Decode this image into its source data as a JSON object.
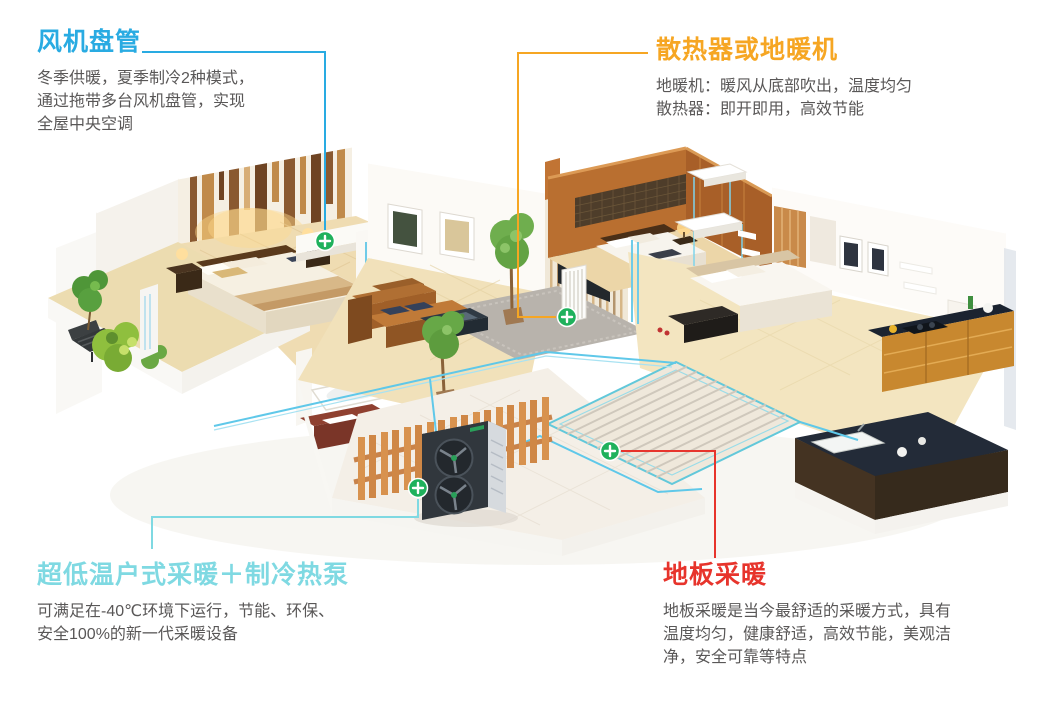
{
  "page": {
    "background": "#ffffff",
    "width": 1042,
    "height": 710
  },
  "colors": {
    "cyan_accent": "#29abe2",
    "light_cyan_accent": "#7fd9e2",
    "orange_accent": "#f6a623",
    "red_accent": "#e7342c",
    "body_text": "#595757",
    "marker_green": "#1fb15c"
  },
  "annotations": {
    "fan_coil": {
      "title": "风机盘管",
      "lines": {
        "0": "冬季供暖，夏季制冷2种模式，",
        "1": "通过拖带多台风机盘管，实现",
        "2": "全屋中央空调"
      }
    },
    "radiator": {
      "title": "散热器或地暖机",
      "lines": {
        "0": "地暖机：暖风从底部吹出，温度均匀",
        "1": "散热器：即开即用，高效节能"
      }
    },
    "heat_pump": {
      "title": "超低温户式采暖＋制冷热泵",
      "lines": {
        "0": "可满足在-40℃环境下运行，节能、环保、",
        "1": "安全100%的新一代采暖设备"
      }
    },
    "floor_heating": {
      "title": "地板采暖",
      "lines": {
        "0": "地板采暖是当今最舒适的采暖方式，具有",
        "1": "温度均匀，健康舒适，高效节能，美观洁",
        "2": "净，安全可靠等特点"
      }
    }
  },
  "illustration": {
    "description": "Isometric cutaway apartment: left bedroom with balcony plants, living room with sofa and TV wall, orange wood bedroom with hanging floor-heater units and radiators, second bedroom, kitchen, bathroom with tub, underfloor heating coil, wooden fence and outdoor ultra-low-temperature heat pump, all connected by cyan pipes.",
    "marker_symbol": "+",
    "markers": {
      "fan_coil": "风机盘管",
      "radiator": "散热器或地暖机",
      "heat_pump": "超低温户式采暖＋制冷热泵",
      "floor_heating": "地板采暖"
    }
  }
}
